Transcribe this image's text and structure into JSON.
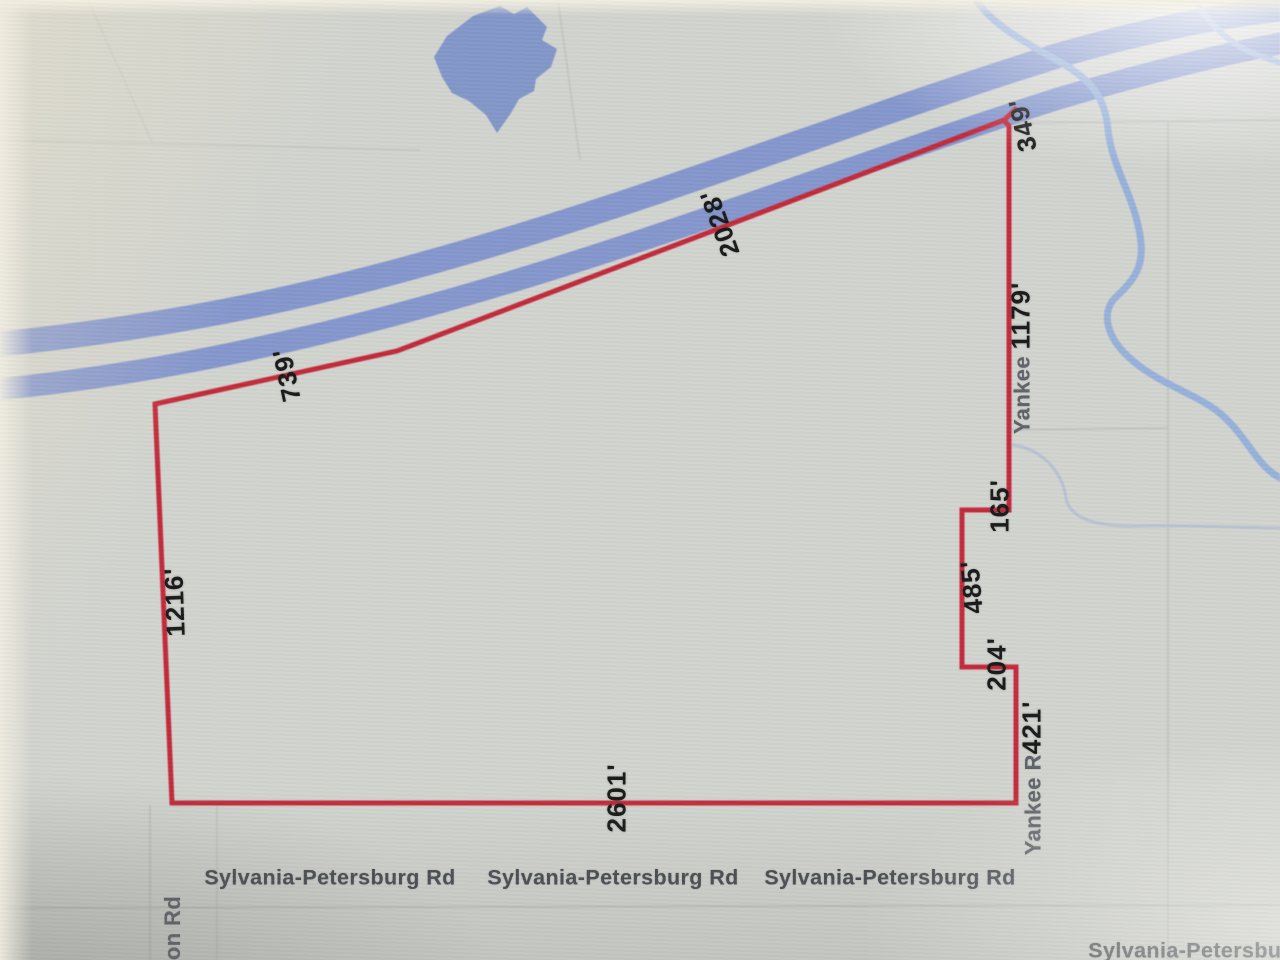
{
  "colors": {
    "background": "#d2d4cf",
    "river": "#8597cd",
    "stream": "#97b1da",
    "pond": "#7e93c9",
    "boundary": "#c32a3a",
    "dimension_text": "#1a1a1a",
    "road_text": "#474c52",
    "road_text_gray": "#5e6369",
    "faint_line": "#aeb3b1",
    "faint_blue_line": "#b3bdd4"
  },
  "parcel": {
    "dimensions": {
      "d739": "739'",
      "d2028": "2028'",
      "d349": "349'",
      "d1216": "1216'",
      "d2601": "2601'",
      "d165": "165'",
      "d485": "485'",
      "d204": "204'",
      "d1179": "1179'",
      "d421": "421'"
    }
  },
  "roads": {
    "yankee_upper": "Yankee ",
    "yankee_lower": "Yankee R",
    "sylvania_1": "Sylvania-Petersburg Rd",
    "sylvania_2": "Sylvania-Petersburg Rd",
    "sylvania_3": "Sylvania-Petersburg Rd",
    "sylvania_partial": "Sylvania-Petersburg",
    "on_rd_partial": "on Rd"
  }
}
